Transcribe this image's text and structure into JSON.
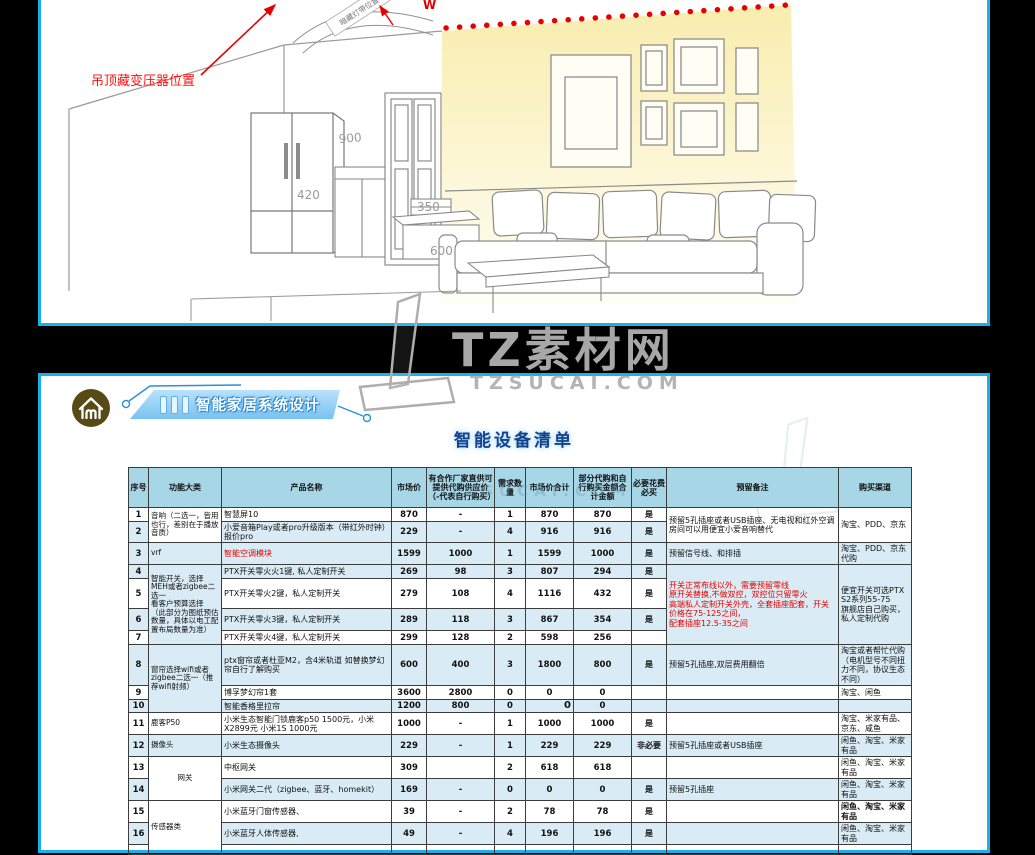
{
  "watermark": {
    "title": "TZ素材网",
    "subtitle": "TZSUCAI.COM"
  },
  "top_panel": {
    "callout_label": "吊顶藏变压器位置",
    "strip_label": "暗藏灯带位置",
    "w_label": "W",
    "dim_900": "900",
    "dim_420": "420",
    "dim_350": "350",
    "dim_600": "600"
  },
  "bottom_panel": {
    "logo_text": "mi",
    "banner_title": "智能家居系统设计",
    "list_title": "智能设备清单",
    "table": {
      "headers": {
        "no": "序号",
        "category": "功能大类",
        "product": "产品名称",
        "price": "市场价",
        "supply": "有合作厂家直供可提供代购供应价（-代表自行购买）",
        "qty": "需求数量",
        "total": "市场价合计",
        "buy_total": "部分代购和自行购买金额合计金额",
        "must": "必要花费必买",
        "note": "预留备注",
        "channel": "购买渠道"
      },
      "rows": [
        {
          "no": "1",
          "category": "音响（二选一，皆用也行，差别在于播放音质）",
          "product": "智慧屏10",
          "price": "870",
          "supply": "-",
          "qty": "1",
          "total": "870",
          "buy_total": "870",
          "must": "是",
          "note": "预留5孔插座或者USB插座、无电视和红外空调房间可以用便宜小爱音响替代",
          "channel": "淘宝、PDD、京东"
        },
        {
          "no": "2",
          "product": "小爱音箱Play或者pro升级版本（带红外时钟）报价pro",
          "price": "229",
          "supply": "-",
          "qty": "4",
          "total": "916",
          "buy_total": "916",
          "must": "是"
        },
        {
          "no": "3",
          "category": "vrf",
          "product": "智能空调模块",
          "price": "1599",
          "supply": "1000",
          "qty": "1",
          "total": "1599",
          "buy_total": "1000",
          "must": "是",
          "note": "预留信号线、和排插",
          "channel": "淘宝、PDD、京东\n代购"
        },
        {
          "no": "4",
          "category": "智能开关，选择MEH或者zigbee二选一\n看客户预算选择\n（此部分为图纸预估数量，具体以电工配置布局数量为准）",
          "product": "PTX开关零火火1键, 私人定制开关",
          "price": "269",
          "supply": "98",
          "qty": "3",
          "total": "807",
          "buy_total": "294",
          "must": "是",
          "note": "开关正常布线以外，需要预留零线\n原开关替换,不做双控，双控位只留零火\n高端私人定制开关外壳，全套插座配套，开关价格在75-125之间，\n配套插座12.5-35之间",
          "channel": "便宜开关可选PTX S2系列55-75\n旗舰店自己购买，私人定制代购"
        },
        {
          "no": "5",
          "product": "PTX开关零火2键，私人定制开关",
          "price": "279",
          "supply": "108",
          "qty": "4",
          "total": "1116",
          "buy_total": "432",
          "must": "是"
        },
        {
          "no": "6",
          "product": "PTX开关零火3键，私人定制开关",
          "price": "289",
          "supply": "118",
          "qty": "3",
          "total": "867",
          "buy_total": "354",
          "must": "是"
        },
        {
          "no": "7",
          "product": "PTX开关零火4键，私人定制开关",
          "price": "299",
          "supply": "128",
          "qty": "2",
          "total": "598",
          "buy_total": "256",
          "must": ""
        },
        {
          "no": "8",
          "category": "窗帘选择wifi或者zigbee二选一（推荐wifi射频）",
          "product": "ptx窗帘或者杜亚M2，含4米轨道\n如替换梦幻帘自行了解购买",
          "price": "600",
          "supply": "400",
          "qty": "3",
          "total": "1800",
          "buy_total": "800",
          "must": "是",
          "note": "预留5孔插座,双层费用翻倍",
          "channel": "淘宝或者帮忙代购\n（电机型号不同扭力不同，协议生态不同）"
        },
        {
          "no": "9",
          "product": "博孚梦幻帘1套",
          "price": "3600",
          "supply": "2800",
          "qty": "0",
          "total": "0",
          "buy_total": "0",
          "must": "",
          "note": "",
          "channel": "淘宝、闲鱼"
        },
        {
          "no": "10",
          "product": "智能香格里拉帘",
          "price": "1200",
          "supply": "800",
          "qty": "0",
          "total": "0",
          "buy_total": "0",
          "must": "",
          "note": "",
          "channel": ""
        },
        {
          "no": "11",
          "category": "鹿客P50",
          "product": "小米生态智能门锁鹿客p50 1500元，小米X2899元 小米1S 1000元",
          "price": "1000",
          "supply": "-",
          "qty": "1",
          "total": "1000",
          "buy_total": "1000",
          "must": "是",
          "note": "",
          "channel": "淘宝、米家有品、京东、咸鱼"
        },
        {
          "no": "12",
          "category": "摄像头",
          "product": "小米生态摄像头",
          "price": "229",
          "supply": "-",
          "qty": "1",
          "total": "229",
          "buy_total": "229",
          "must": "非必要",
          "note": "预留5孔插座或者USB插座",
          "channel": "闲鱼、淘宝、米家有品"
        },
        {
          "no": "13",
          "category": "网关",
          "product": "中枢网关",
          "price": "309",
          "supply": "",
          "qty": "2",
          "total": "618",
          "buy_total": "618",
          "must": "",
          "note": "",
          "channel": "闲鱼、淘宝、米家有品"
        },
        {
          "no": "14",
          "product": "小米网关二代（zigbee、蓝牙、homekit）",
          "price": "169",
          "supply": "-",
          "qty": "0",
          "total": "0",
          "buy_total": "0",
          "must": "是",
          "note": "预留5孔插座",
          "channel": "闲鱼、淘宝、米家有品"
        },
        {
          "no": "15",
          "category": "传感器类",
          "product": "小米蓝牙门窗传感器、",
          "price": "39",
          "supply": "-",
          "qty": "2",
          "total": "78",
          "buy_total": "78",
          "must": "是",
          "note": "",
          "channel": "闲鱼、淘宝、米家有品"
        },
        {
          "no": "16",
          "product": "小米蓝牙人体传感器,",
          "price": "49",
          "supply": "-",
          "qty": "4",
          "total": "196",
          "buy_total": "196",
          "must": "是",
          "note": "",
          "channel": "闲鱼、淘宝、米家有品"
        }
      ]
    }
  }
}
